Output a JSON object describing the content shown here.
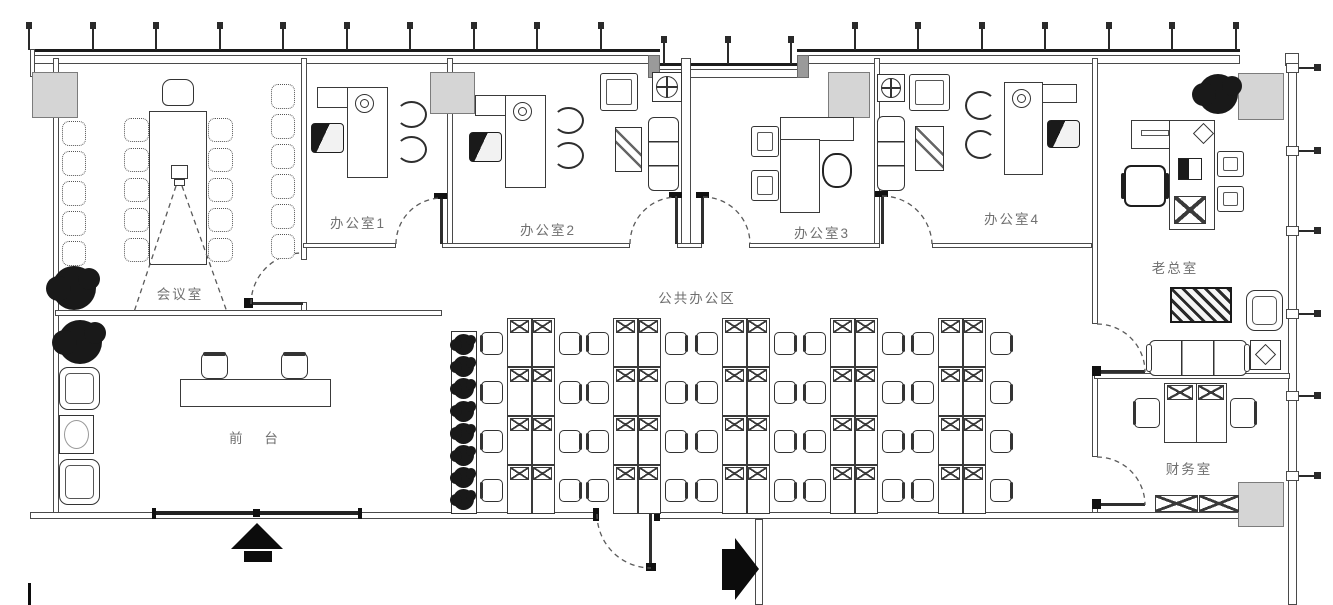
{
  "rooms": {
    "meeting": {
      "label": "会议室"
    },
    "office1": {
      "label": "办公室1"
    },
    "office2": {
      "label": "办公室2"
    },
    "office3": {
      "label": "办公室3"
    },
    "office4": {
      "label": "办公室4"
    },
    "open_area": {
      "label": "公共办公区"
    },
    "reception": {
      "label": "前 台"
    },
    "boss": {
      "label": "老总室"
    },
    "finance": {
      "label": "财务室"
    }
  },
  "workstations": {
    "clusters": 5,
    "rows_per_cluster": 4,
    "desks_per_row": 2,
    "total_desks": 40
  },
  "meeting_room": {
    "table_side_chairs": 10,
    "wall_chairs_left": 5,
    "wall_chairs_right": 6
  },
  "icons": {
    "entrance_up_arrow": "filled up arrow at main entrance",
    "entrance_right_arrow": "filled right arrow at side entrance",
    "plant": "black foliage blob",
    "column": "gray structural column",
    "ceiling_diffuser": "square with circle and cross"
  },
  "colors": {
    "background": "#ffffff",
    "wall_line": "#3a3a3a",
    "thick_edge": "#1c1c1c",
    "column_fill": "#d5d5d5",
    "label_text": "#707070",
    "black_fill": "#0c0c0c"
  }
}
